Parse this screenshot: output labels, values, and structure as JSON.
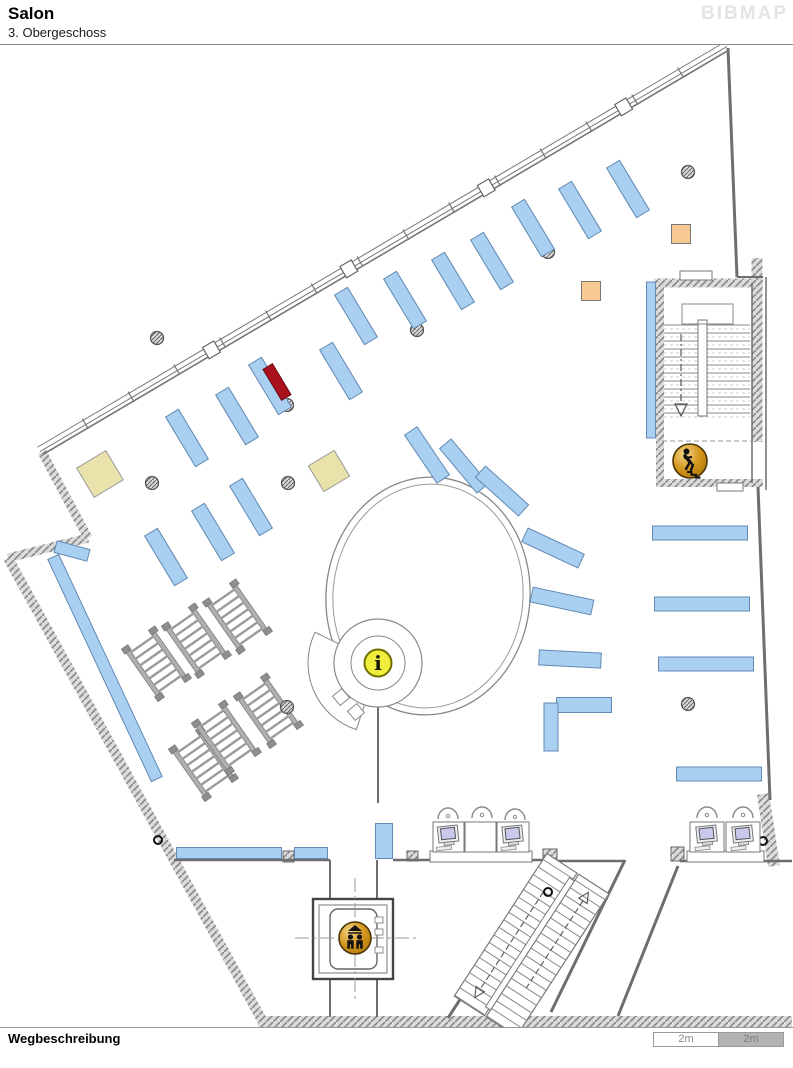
{
  "header": {
    "title": "Salon",
    "subtitle": "3. Obergeschoss",
    "logo": "BIBMAP"
  },
  "footer": {
    "label": "Wegbeschreibung",
    "scale": [
      {
        "label": "2m",
        "filled": false
      },
      {
        "label": "2m",
        "filled": true
      }
    ]
  },
  "map": {
    "colors": {
      "shelf": "#A9CFF1",
      "shelf_border": "#6189B4",
      "red": "#A8131E",
      "beige": "#E9E3AB",
      "orange": "#F8C993",
      "wall": "#6E6E6E",
      "gold_border": "#4A3404",
      "yellow": "#F0ED3C",
      "monitor": "#C9C9EC",
      "bench": "#AFAFAF"
    },
    "shelves": [
      [
        356,
        316,
        -31,
        15,
        58
      ],
      [
        405,
        300,
        -31,
        15,
        58
      ],
      [
        453,
        281,
        -31,
        15,
        58
      ],
      [
        492,
        261,
        -31,
        15,
        58
      ],
      [
        533,
        228,
        -31,
        15,
        58
      ],
      [
        580,
        210,
        -31,
        15,
        58
      ],
      [
        628,
        189,
        -31,
        15,
        58
      ],
      [
        187,
        438,
        -31,
        15,
        58
      ],
      [
        237,
        416,
        -31,
        15,
        58
      ],
      [
        270,
        386,
        -31,
        15,
        58
      ],
      [
        341,
        371,
        -31,
        15,
        58
      ],
      [
        166,
        557,
        -31,
        15,
        58
      ],
      [
        213,
        532,
        -31,
        15,
        58
      ],
      [
        251,
        507,
        -31,
        15,
        58
      ],
      [
        427,
        455,
        -34,
        15,
        58
      ],
      [
        464,
        466,
        -40,
        15,
        58
      ],
      [
        502,
        491,
        -48,
        15,
        58
      ],
      [
        553,
        548,
        -65,
        15,
        62
      ],
      [
        562,
        601,
        -78,
        15,
        62
      ],
      [
        570,
        659,
        -87,
        15,
        62
      ],
      [
        584,
        705,
        -90,
        15,
        55
      ],
      [
        551,
        727,
        0,
        14,
        48
      ],
      [
        700,
        533,
        -90,
        14,
        95
      ],
      [
        702,
        604,
        -90,
        14,
        95
      ],
      [
        706,
        664,
        -90,
        14,
        95
      ],
      [
        719,
        774,
        -90,
        14,
        85
      ],
      [
        651,
        360,
        0,
        9,
        156
      ],
      [
        229,
        853,
        0,
        105,
        11
      ],
      [
        311,
        853,
        0,
        33,
        11
      ],
      [
        384,
        841,
        0,
        17,
        35
      ],
      [
        105,
        668,
        -25,
        12,
        245
      ],
      [
        72,
        551,
        -75,
        12,
        34
      ]
    ],
    "red_marker": [
      277,
      382,
      -31,
      11,
      36
    ],
    "squares_beige": [
      [
        100,
        474,
        34,
        -31
      ],
      [
        329,
        471,
        30,
        -31
      ]
    ],
    "squares_orange": [
      [
        681,
        234,
        19
      ],
      [
        591,
        291,
        19
      ]
    ],
    "pillars": [
      [
        157,
        338
      ],
      [
        417,
        330
      ],
      [
        548,
        252
      ],
      [
        688,
        172
      ],
      [
        287,
        405
      ],
      [
        152,
        483
      ],
      [
        288,
        483
      ],
      [
        287,
        707
      ],
      [
        688,
        704
      ]
    ],
    "door_rings": [
      [
        158,
        840
      ],
      [
        548,
        892
      ],
      [
        763,
        841
      ]
    ],
    "benches": {
      "units": [
        [
          156,
          664
        ],
        [
          196,
          641
        ],
        [
          237,
          617
        ],
        [
          203,
          764
        ],
        [
          226,
          738
        ],
        [
          268,
          711
        ]
      ],
      "angle": -35,
      "w": 36,
      "h": 60,
      "rungs": 7
    },
    "walls_hatch": [
      [
        42,
        452,
        88,
        538,
        9
      ],
      [
        88,
        538,
        8,
        558,
        9
      ],
      [
        8,
        558,
        263,
        1022,
        10
      ],
      [
        258,
        1022,
        792,
        1022,
        12
      ],
      [
        654,
        283,
        763,
        283,
        9
      ],
      [
        660,
        279,
        660,
        486,
        8
      ],
      [
        656,
        483,
        763,
        483,
        8
      ],
      [
        757,
        258,
        757,
        442,
        11
      ],
      [
        763,
        794,
        774,
        866,
        12
      ]
    ],
    "wall_columns": [
      [
        543,
        849,
        14,
        13
      ],
      [
        407,
        851,
        11,
        10
      ],
      [
        283,
        851,
        11,
        11
      ],
      [
        671,
        847,
        13,
        14
      ]
    ],
    "walls_thin": [
      [
        728,
        48,
        737,
        277,
        3
      ],
      [
        737,
        277,
        763,
        277,
        2
      ],
      [
        758,
        487,
        770,
        800,
        3
      ],
      [
        174,
        860,
        330,
        860,
        2.5
      ],
      [
        393,
        860,
        546,
        860,
        2.5
      ],
      [
        550,
        861,
        625,
        861,
        2.5
      ],
      [
        680,
        861,
        792,
        861,
        2.5
      ],
      [
        330,
        860,
        330,
        901,
        2
      ],
      [
        377,
        860,
        377,
        901,
        2
      ],
      [
        330,
        977,
        330,
        1017,
        2
      ],
      [
        377,
        977,
        377,
        1017,
        2
      ],
      [
        548,
        864,
        448,
        1018,
        3
      ],
      [
        625,
        860,
        551,
        1012,
        3
      ],
      [
        678,
        866,
        618,
        1016,
        3
      ],
      [
        752,
        283,
        752,
        483,
        1.5
      ],
      [
        766,
        277,
        766,
        490,
        1.5
      ],
      [
        378,
        707,
        378,
        803,
        2
      ]
    ],
    "walls_dashed": [
      [
        662,
        441,
        753,
        441
      ]
    ],
    "window_wall": {
      "x1": 42,
      "y1": 455,
      "x2": 729,
      "y2": 50,
      "offsets": [
        0,
        4,
        9
      ],
      "ticks": 14,
      "nodes": [
        0.25,
        0.45,
        0.65,
        0.85
      ],
      "node_size": 13
    },
    "stair_top": {
      "x1": 664,
      "x2": 750,
      "y1": 325,
      "y2": 414,
      "step": 8,
      "divider": [
        698,
        320,
        9,
        96
      ],
      "landing": [
        682,
        304,
        51,
        20
      ],
      "arrow": {
        "x": 681,
        "y1": 334,
        "y2": 404
      },
      "doors": [
        [
          680,
          271,
          32,
          9
        ],
        [
          717,
          483,
          26,
          8
        ]
      ]
    },
    "stair_diag": {
      "rot": 33,
      "cx": 528,
      "cy": 945,
      "flights": [
        [
          494,
          858,
          36,
          170
        ],
        [
          532,
          858,
          36,
          170
        ]
      ],
      "step": 9,
      "divider": [
        526,
        866,
        6,
        154
      ],
      "arrows": [
        {
          "x": 512,
          "y1": 892,
          "y2": 1008,
          "dir": "down"
        },
        {
          "x": 550,
          "y1": 878,
          "y2": 982,
          "dir": "up"
        }
      ]
    },
    "elevator": {
      "shaft": [
        313,
        899,
        80,
        80
      ],
      "inner": [
        319,
        905,
        68,
        68
      ],
      "car": [
        330,
        909,
        47,
        60
      ],
      "notches": [
        [
          375,
          917,
          8,
          6
        ],
        [
          375,
          929,
          8,
          6
        ],
        [
          375,
          947,
          8,
          6
        ]
      ],
      "cross_h": [
        295,
        938,
        416,
        938
      ],
      "cross_v": [
        355,
        878,
        355,
        1000
      ]
    },
    "oval": {
      "cx": 428,
      "cy": 596,
      "rx": 102,
      "ry": 119,
      "rot": 5,
      "gap": 7
    },
    "info_desk": {
      "cx": 378,
      "cy": 663,
      "r_outer": 44,
      "r_inner": 27,
      "sector": {
        "ro": 70,
        "ri": 42,
        "a1": 108,
        "a2": 206
      },
      "squares": [
        [
          341,
          697
        ],
        [
          356,
          712
        ]
      ],
      "square_size": 12,
      "square_rot": -40
    },
    "desks": [
      {
        "base": [
          430,
          851,
          102,
          11
        ],
        "carrels": [
          {
            "x": 433,
            "y": 822,
            "w": 31,
            "h": 30,
            "monitor": true
          },
          {
            "x": 465,
            "y": 822,
            "w": 31,
            "h": 30,
            "monitor": false
          },
          {
            "x": 497,
            "y": 822,
            "w": 32,
            "h": 30,
            "monitor": true
          }
        ],
        "chairs": [
          [
            448,
            812
          ],
          [
            482,
            811
          ],
          [
            515,
            813
          ]
        ]
      },
      {
        "base": [
          687,
          851,
          77,
          11
        ],
        "carrels": [
          {
            "x": 690,
            "y": 822,
            "w": 34,
            "h": 30,
            "monitor": true
          },
          {
            "x": 726,
            "y": 822,
            "w": 34,
            "h": 30,
            "monitor": true
          }
        ],
        "chairs": [
          [
            707,
            811
          ],
          [
            743,
            811
          ]
        ]
      }
    ],
    "icons": [
      {
        "type": "info",
        "x": 378,
        "y": 663,
        "r": 13.5
      },
      {
        "type": "elevator",
        "x": 355,
        "y": 938,
        "r": 16
      },
      {
        "type": "stairs-down",
        "x": 690,
        "y": 461,
        "r": 17
      }
    ]
  }
}
